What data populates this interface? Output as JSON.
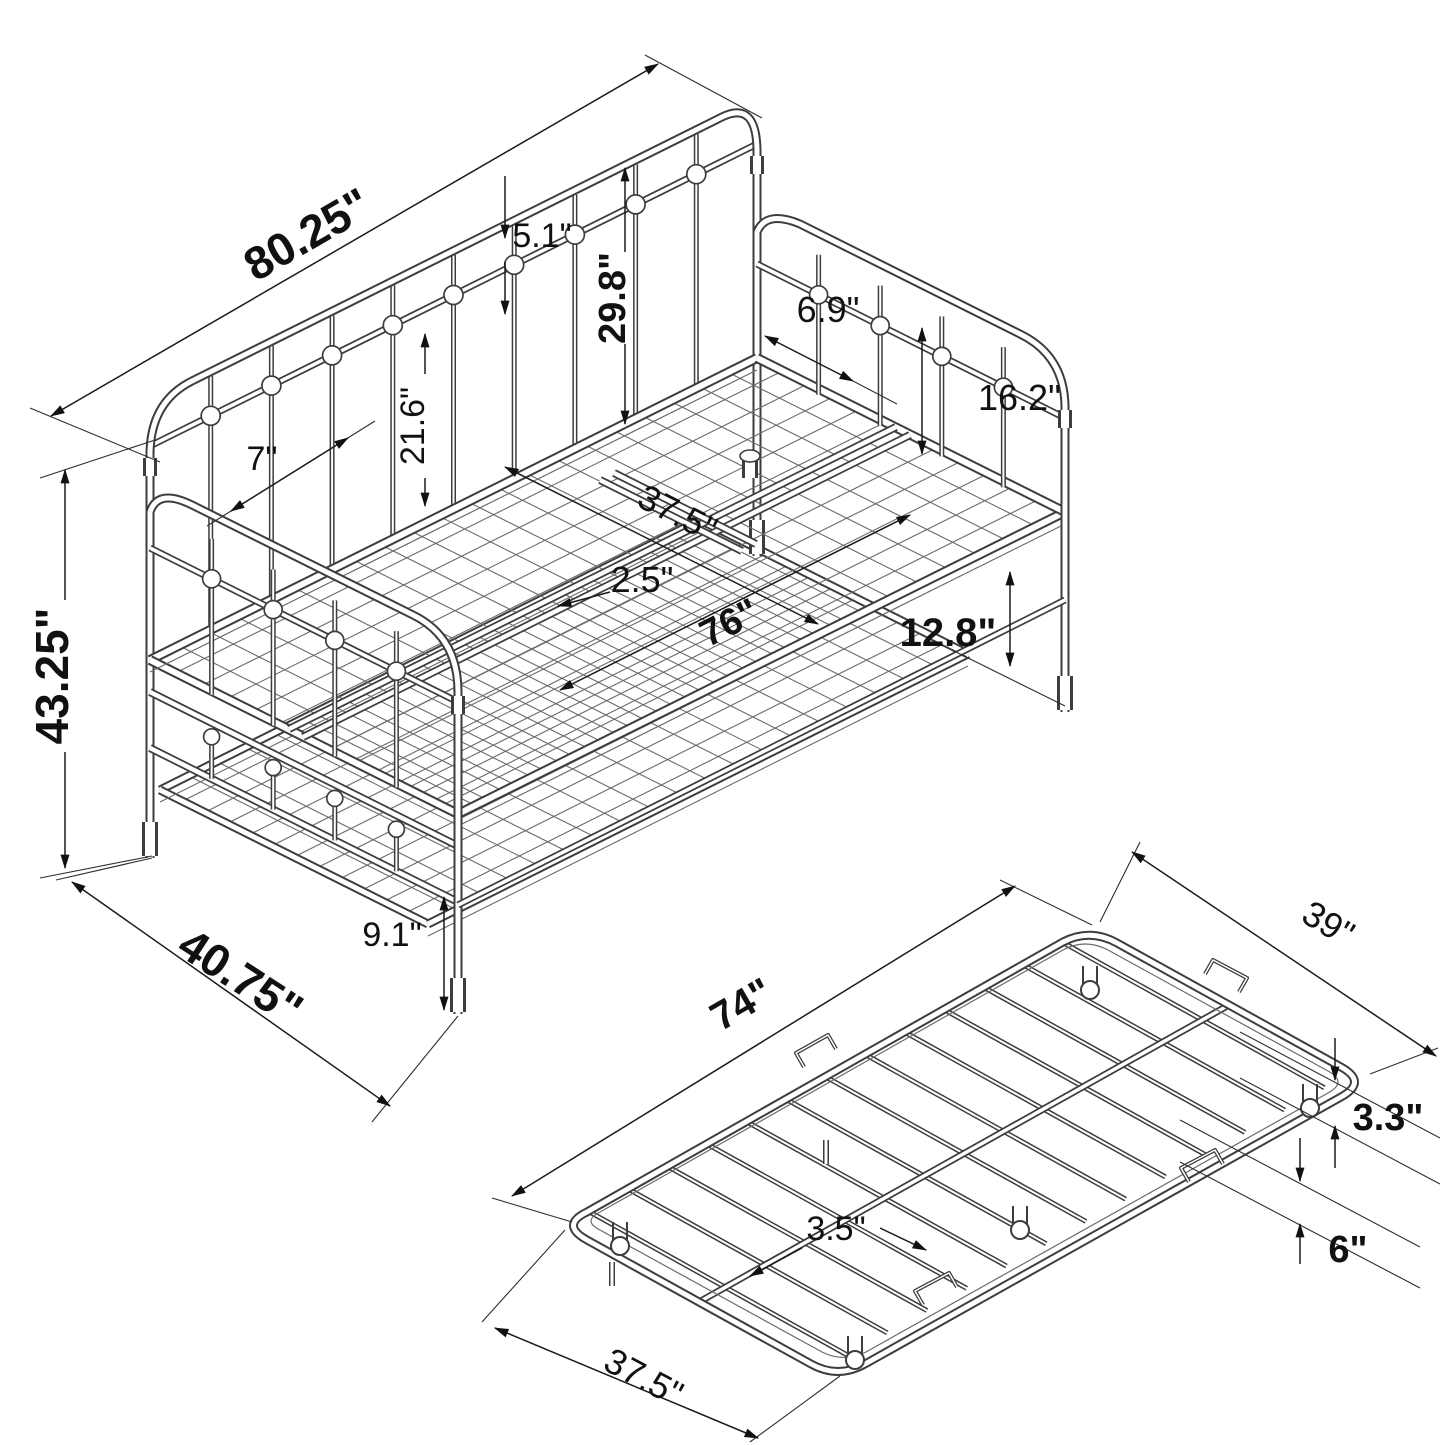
{
  "diagram": {
    "daybed": {
      "dims": {
        "overall_length": "80.25\"",
        "back_rail_gap": "5.1\"",
        "back_height": "29.8\"",
        "arm_spindle_spacing": "6.9\"",
        "arm_height": "16.2\"",
        "post_spacing": "7\"",
        "spindle_height": "21.6\"",
        "deck_width": "37.5\"",
        "support_rail_gap": "2.5\"",
        "deck_length": "76\"",
        "deck_clearance": "12.8\"",
        "overall_height": "43.25\"",
        "lower_rail_height": "9.1\"",
        "overall_depth": "40.75\""
      }
    },
    "trundle": {
      "dims": {
        "length": "74\"",
        "width": "39\"",
        "slat_spacing": "3.5\"",
        "frame_height": "3.3\"",
        "caster_clearance": "6\"",
        "end_width": "37.5\""
      }
    },
    "colors": {
      "structure_line": "#3d3d3d",
      "mesh_line": "#6b6b6b",
      "dimension_line": "#1a1a1a",
      "text": "#111111",
      "background": "#ffffff"
    }
  }
}
